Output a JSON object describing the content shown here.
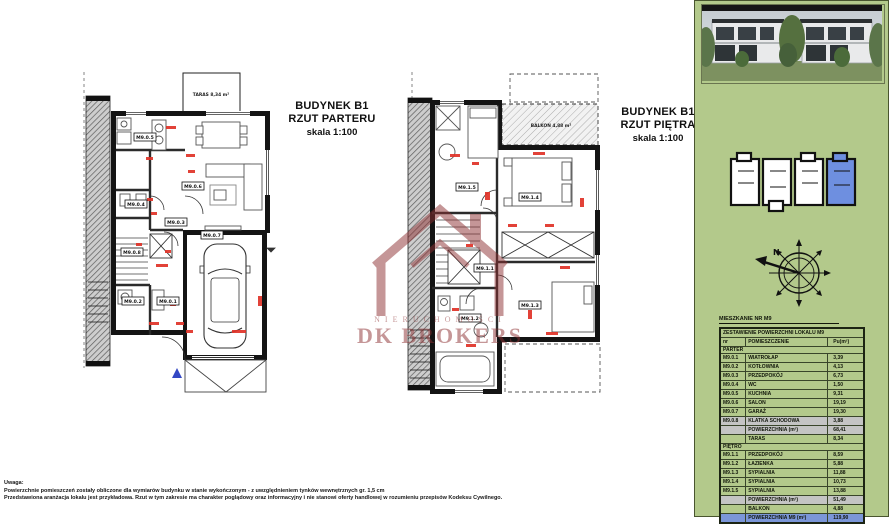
{
  "plans": {
    "parter": {
      "title_line1": "BUDYNEK B1",
      "title_line2": "RZUT PARTERU",
      "title_line3": "skala 1:100",
      "taras_label": "TARAS 8,34 m²",
      "rooms": [
        "M9.0.5",
        "M9.0.6",
        "M9.0.4",
        "M9.0.3",
        "M9.0.8",
        "M9.0.2",
        "M9.0.1",
        "M9.0.7"
      ]
    },
    "pietro": {
      "title_line1": "BUDYNEK B1",
      "title_line2": "RZUT PIĘTRA",
      "title_line3": "skala 1:100",
      "balkon_label": "BALKON 4,88 m²",
      "rooms": [
        "M9.1.5",
        "M9.1.4",
        "M9.1.1",
        "M9.1.2",
        "M9.1.3"
      ]
    }
  },
  "watermark": {
    "line1": "NIERUCHOMOŚCI",
    "line2": "DK BROKERS",
    "color": "#8d3032"
  },
  "sidebar": {
    "compass": {
      "north_label": "N"
    },
    "site_plan": {
      "highlight_color": "#6e8fe0"
    },
    "table": {
      "caption": "MIESZKANIE NR M9",
      "header": "ZESTAWIENIE POWIERZCHNI LOKALU M9",
      "columns": [
        "nr",
        "POMIESZCZENIE",
        "Pu(m²)"
      ],
      "rows": [
        {
          "type": "section",
          "name": "PARTER"
        },
        {
          "nr": "M9.0.1",
          "name": "WIATROŁAP",
          "val": "3,39"
        },
        {
          "nr": "M9.0.2",
          "name": "KOTŁOWNIA",
          "val": "4,13"
        },
        {
          "nr": "M9.0.3",
          "name": "PRZEDPOKÓJ",
          "val": "6,73"
        },
        {
          "nr": "M9.0.4",
          "name": "WC",
          "val": "1,50"
        },
        {
          "nr": "M9.0.5",
          "name": "KUCHNIA",
          "val": "9,31"
        },
        {
          "nr": "M9.0.6",
          "name": "SALON",
          "val": "19,19"
        },
        {
          "nr": "M9.0.7",
          "name": "GARAŻ",
          "val": "19,30"
        },
        {
          "nr": "M9.0.8",
          "name": "KLATKA SCHODOWA",
          "val": "3,88",
          "highlight": "gray"
        },
        {
          "nr": "",
          "name": "POWIERZCHNIA (m²)",
          "val": "68,41",
          "highlight": "gray"
        },
        {
          "nr": "",
          "name": "TARAS",
          "val": "8,34"
        },
        {
          "type": "section",
          "name": "PIĘTRO"
        },
        {
          "nr": "M9.1.1",
          "name": "PRZEDPOKÓJ",
          "val": "8,59"
        },
        {
          "nr": "M9.1.2",
          "name": "ŁAZIENKA",
          "val": "5,88"
        },
        {
          "nr": "M9.1.3",
          "name": "SYPIALNIA",
          "val": "11,88"
        },
        {
          "nr": "M9.1.4",
          "name": "SYPIALNIA",
          "val": "10,73"
        },
        {
          "nr": "M9.1.5",
          "name": "SYPIALNIA",
          "val": "13,88"
        },
        {
          "nr": "",
          "name": "POWIERZCHNIA (m²)",
          "val": "51,49",
          "highlight": "gray"
        },
        {
          "nr": "",
          "name": "BALKON",
          "val": "4,88"
        },
        {
          "nr": "",
          "name": "POWIERZCHNIA M9 (m²)",
          "val": "119,90",
          "highlight": "blue"
        }
      ]
    }
  },
  "footer": {
    "line1": "Uwaga:",
    "line2": "Powierzchnie pomieszczeń zostały obliczone dla wymiarów budynku w stanie wykończonym - z uwzględnieniem tynków wewnętrznych gr. 1,5 cm",
    "line3": "Przedstawiona aranżacja lokalu jest przykładowa. Rzut w tym zakresie ma charakter poglądowy oraz informacyjny i nie stanowi oferty handlowej w rozumieniu przepisów Kodeksu Cywilnego."
  },
  "colors": {
    "sidebar_green": "#b3c98b",
    "siteplan_highlight": "#6e8fe0",
    "table_total_blue": "#7b96d8",
    "table_gray": "#c4c4c4",
    "watermark_red": "#8d3032",
    "dimension_red": "#e03328",
    "entry_triangle_blue": "#3347c4"
  }
}
